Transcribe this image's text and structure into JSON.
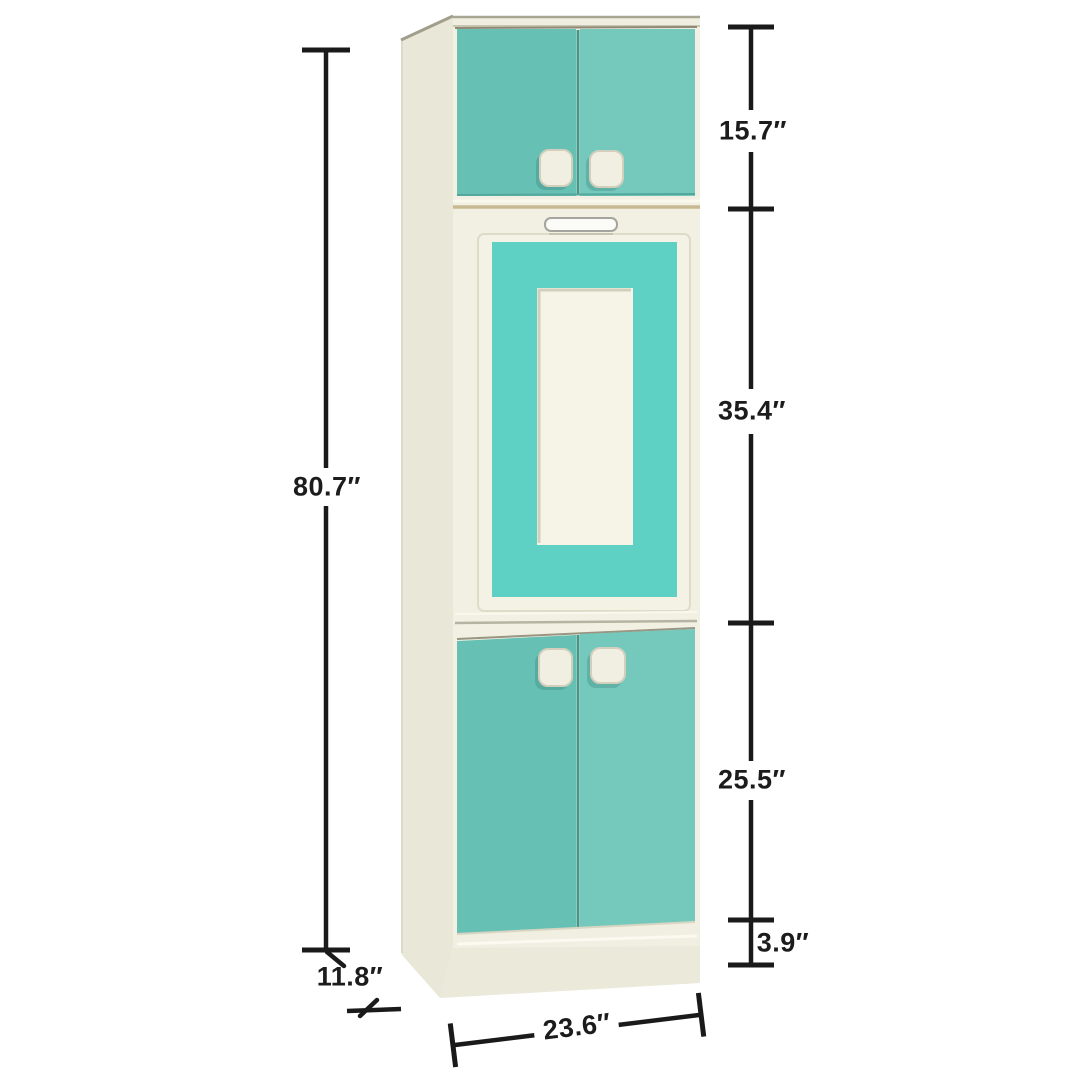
{
  "figure": {
    "kind": "product dimension diagram",
    "background": "#ffffff"
  },
  "dimension_labels": {
    "overall_height": "80.7″",
    "top_section_height": "15.7″",
    "middle_section_height": "35.4″",
    "lower_section_height": "25.5″",
    "base_height": "3.9″",
    "depth": "11.8″",
    "width": "23.6″"
  },
  "colors": {
    "door_teal": "#67c0b4",
    "door_teal_light": "#75c9bc",
    "frame_teal": "#5ed0c4",
    "cabinet_cream": "#f1f0e2",
    "side_cream": "#e9e7d7",
    "plinth_cream": "#ebe9d9",
    "dimension_line": "#1a1a1a"
  }
}
